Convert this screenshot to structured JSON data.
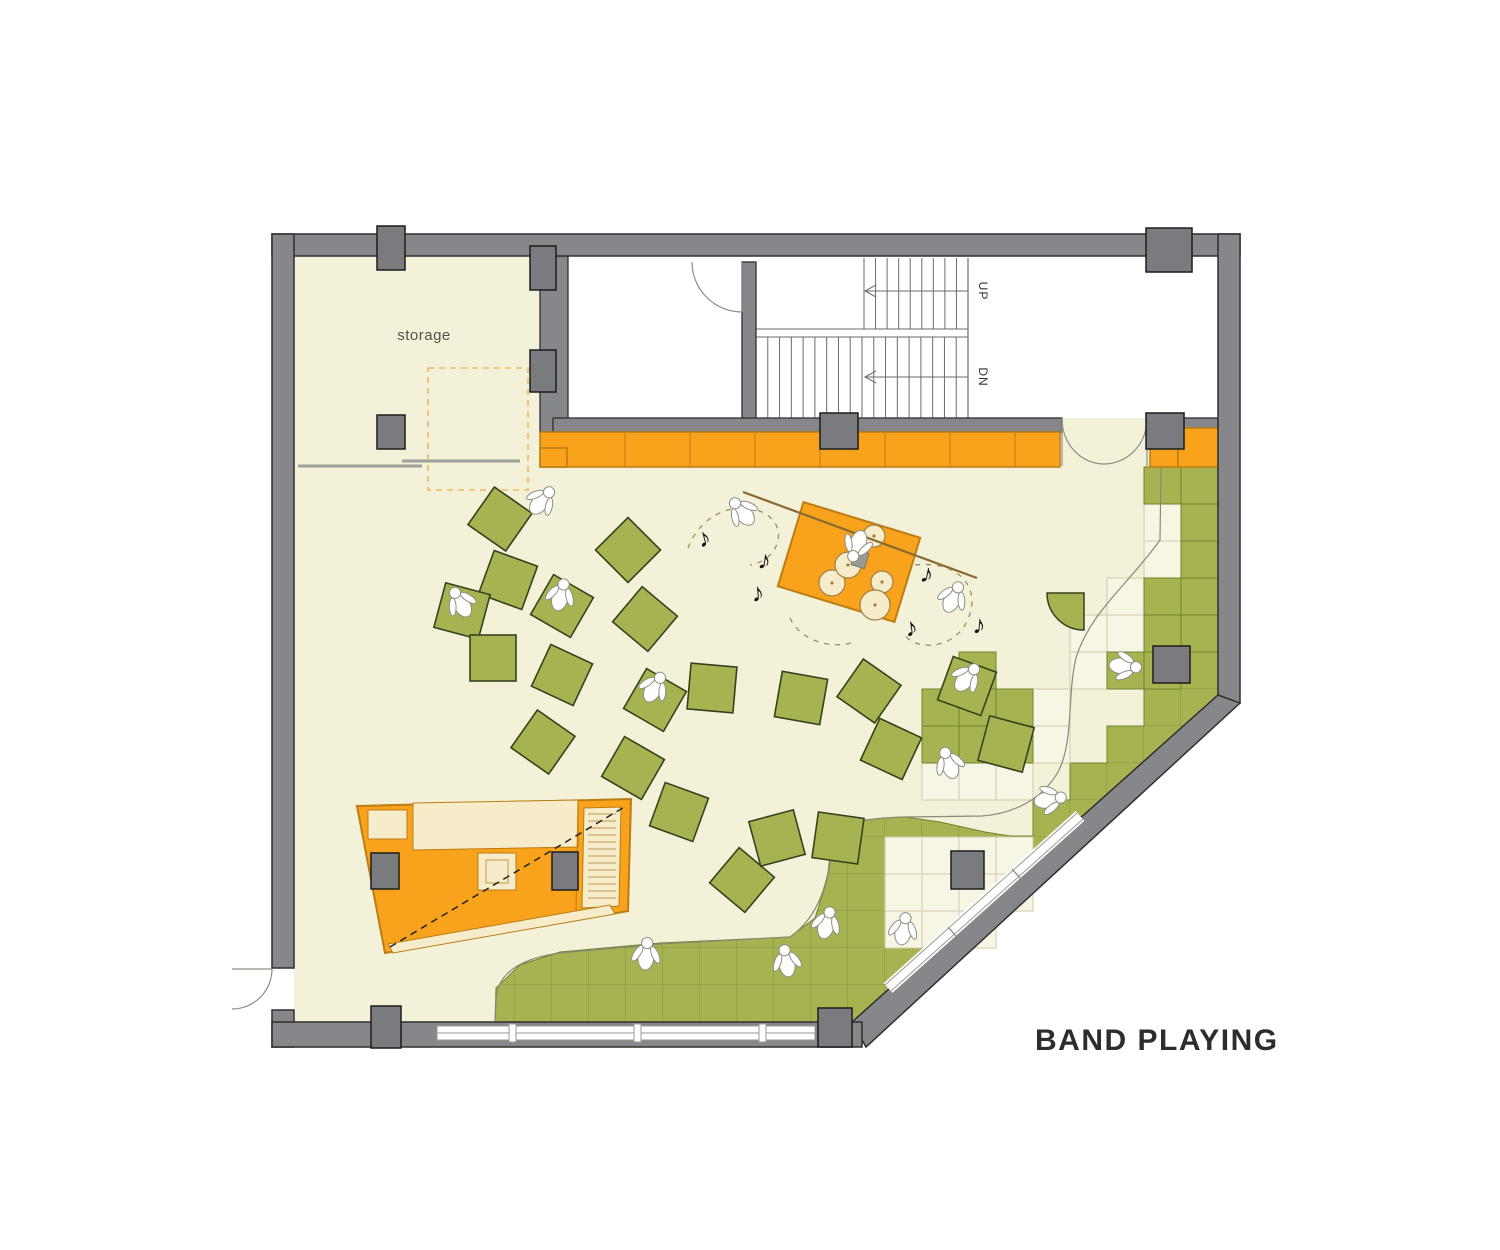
{
  "title": {
    "band_playing": "BAND PLAYING"
  },
  "labels": {
    "storage": "storage",
    "up": "UP",
    "dn": "DN"
  },
  "colors": {
    "floor": "#f4f1d9",
    "tile_cream": "#f7f5e3",
    "tile_cream_line": "#cfccab",
    "green": "#a7b351",
    "green_line": "#74822f",
    "cushion_stroke": "#39411c",
    "orange": "#f9a21b",
    "orange_dark": "#bb7d12",
    "wall": "#85878a",
    "column": "#797b7e",
    "outline": "#2f2f2f",
    "glazing_line": "#9a9a97",
    "note": "#141414",
    "dash_tan": "#9b8d63",
    "stage_line": "#8a6a2f",
    "drum_fill": "#f7ecca",
    "drum_stroke": "#a08040",
    "figure_fill": "#ffffff",
    "figure_stroke": "#8f8f85",
    "text_dark": "#2d2d2d",
    "label_gray": "#52524a",
    "slide_gray": "#a0a09a",
    "dashed_rect": "#ecba62"
  },
  "icons": {
    "music_note_glyph": "♪"
  },
  "cushions": [
    {
      "x": 500,
      "y": 519,
      "r": 35
    },
    {
      "x": 628,
      "y": 550,
      "r": 45
    },
    {
      "x": 508,
      "y": 580,
      "r": 20
    },
    {
      "x": 462,
      "y": 611,
      "r": 15
    },
    {
      "x": 562,
      "y": 606,
      "r": 30
    },
    {
      "x": 493,
      "y": 658,
      "r": 0
    },
    {
      "x": 562,
      "y": 675,
      "r": 25
    },
    {
      "x": 645,
      "y": 619,
      "r": 40
    },
    {
      "x": 712,
      "y": 688,
      "r": 5
    },
    {
      "x": 801,
      "y": 698,
      "r": 10
    },
    {
      "x": 869,
      "y": 691,
      "r": 35
    },
    {
      "x": 967,
      "y": 686,
      "r": 20
    },
    {
      "x": 1006,
      "y": 744,
      "r": 15
    },
    {
      "x": 891,
      "y": 749,
      "r": 25
    },
    {
      "x": 543,
      "y": 742,
      "r": 35
    },
    {
      "x": 633,
      "y": 768,
      "r": 30
    },
    {
      "x": 655,
      "y": 700,
      "r": 30
    },
    {
      "x": 679,
      "y": 812,
      "r": 20
    },
    {
      "x": 742,
      "y": 880,
      "r": 40
    },
    {
      "x": 777,
      "y": 838,
      "r": -15
    },
    {
      "x": 838,
      "y": 838,
      "r": 8
    }
  ],
  "figures": [
    {
      "x": 540,
      "y": 503,
      "r": 40
    },
    {
      "x": 462,
      "y": 605,
      "r": -30
    },
    {
      "x": 560,
      "y": 598,
      "r": 15
    },
    {
      "x": 653,
      "y": 690,
      "r": 30
    },
    {
      "x": 744,
      "y": 514,
      "r": -40
    },
    {
      "x": 952,
      "y": 600,
      "r": 25
    },
    {
      "x": 965,
      "y": 680,
      "r": 40
    },
    {
      "x": 950,
      "y": 766,
      "r": -20
    },
    {
      "x": 1047,
      "y": 800,
      "r": 80
    },
    {
      "x": 1122,
      "y": 666,
      "r": 95
    },
    {
      "x": 903,
      "y": 932,
      "r": 10
    },
    {
      "x": 646,
      "y": 957,
      "r": 5
    },
    {
      "x": 787,
      "y": 964,
      "r": -10
    },
    {
      "x": 826,
      "y": 926,
      "r": 15
    },
    {
      "x": 858,
      "y": 543,
      "r": 200
    }
  ],
  "music_notes": [
    {
      "x": 700,
      "y": 548,
      "r": -15
    },
    {
      "x": 757,
      "y": 568,
      "r": 8
    },
    {
      "x": 752,
      "y": 602,
      "r": -5
    },
    {
      "x": 919,
      "y": 581,
      "r": 12
    },
    {
      "x": 906,
      "y": 637,
      "r": -8
    },
    {
      "x": 972,
      "y": 633,
      "r": 5
    }
  ],
  "columns": [
    [
      377,
      226,
      28,
      44
    ],
    [
      1146,
      228,
      46,
      44
    ],
    [
      377,
      415,
      28,
      34
    ],
    [
      530,
      246,
      26,
      44
    ],
    [
      530,
      350,
      26,
      42
    ],
    [
      820,
      413,
      38,
      36
    ],
    [
      1146,
      413,
      38,
      36
    ],
    [
      1153,
      646,
      37,
      37
    ],
    [
      951,
      851,
      33,
      38
    ],
    [
      371,
      853,
      28,
      36
    ],
    [
      552,
      852,
      26,
      38
    ],
    [
      371,
      1006,
      30,
      42
    ],
    [
      818,
      1008,
      34,
      39
    ]
  ],
  "green_tiles": [
    [
      1144,
      467,
      2,
      1
    ],
    [
      1181,
      504,
      1,
      4
    ],
    [
      1144,
      578,
      1,
      2
    ],
    [
      1144,
      652,
      1,
      1
    ],
    [
      1107,
      652,
      1,
      1
    ],
    [
      922,
      689,
      3,
      2
    ],
    [
      959,
      652,
      1,
      1
    ]
  ],
  "cream_tiles": [
    [
      1144,
      504,
      1,
      2
    ],
    [
      1107,
      578,
      1,
      2
    ],
    [
      1070,
      615,
      1,
      2
    ],
    [
      1033,
      689,
      1,
      2
    ],
    [
      922,
      763,
      3,
      1
    ],
    [
      885,
      837,
      3,
      3
    ],
    [
      996,
      837,
      1,
      2
    ]
  ],
  "orange_band": {
    "x": 540,
    "y": 432,
    "w": 520,
    "h": 35,
    "dividers": [
      625,
      690,
      755,
      820,
      885,
      950,
      1015
    ],
    "left_step": [
      540,
      448,
      27,
      19
    ],
    "right_small": [
      1150,
      448,
      28,
      19
    ],
    "right_big": [
      1178,
      428,
      40,
      39
    ]
  },
  "stage": {
    "cx": 849,
    "cy": 562,
    "w": 122,
    "h": 88,
    "angle": 17
  },
  "drums": [
    [
      832,
      583,
      13
    ],
    [
      848,
      565,
      13
    ],
    [
      874,
      536,
      11
    ],
    [
      882,
      582,
      11
    ],
    [
      875,
      605,
      15
    ]
  ],
  "stair": {
    "upper_treads": {
      "x1": 864,
      "x2": 968,
      "y1": 258,
      "y2": 329,
      "count": 10
    },
    "lower_treads": {
      "x1": 756,
      "x2": 968,
      "y1": 337,
      "y2": 418,
      "count": 19
    },
    "landing_lines": [
      329,
      337
    ],
    "arrow_upper_y": 291,
    "arrow_lower_y": 377,
    "arrow_x1": 865,
    "arrow_x2": 968
  },
  "bar_shelf_lines": {
    "x1": 588,
    "x2": 616,
    "y_start": 814,
    "y_end": 898,
    "step": 7
  }
}
